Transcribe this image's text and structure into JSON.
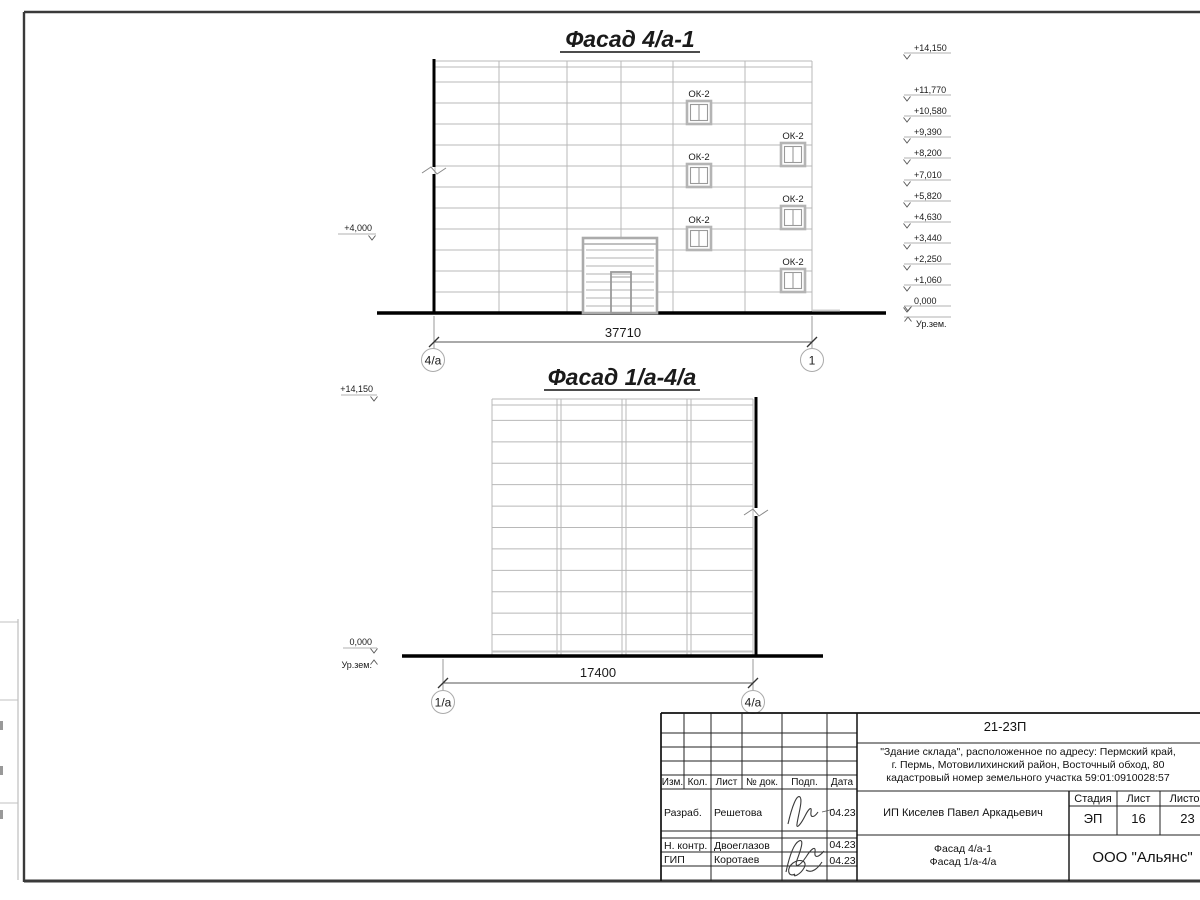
{
  "colors": {
    "paper": "#ffffff",
    "ink": "#1a1a1a",
    "grid": "#b8b8b8"
  },
  "facade_top": {
    "title": "Фасад 4/а-1",
    "window_label": "ОК-2",
    "left_elevation": "+4,000",
    "right_elevations": [
      "+14,150",
      "+11,770",
      "+10,580",
      "+9,390",
      "+8,200",
      "+7,010",
      "+5,820",
      "+4,630",
      "+3,440",
      "+2,250",
      "+1,060",
      "0,000"
    ],
    "ground_label": "Ур.зем.",
    "dimension": "37710",
    "axis_left": "4/а",
    "axis_right": "1"
  },
  "facade_side": {
    "title": "Фасад 1/а-4/а",
    "top_elevation": "+14,150",
    "zero_elevation": "0,000",
    "ground_label": "Ур.зем.",
    "dimension": "17400",
    "axis_left": "1/а",
    "axis_right": "4/а"
  },
  "title_block": {
    "code": "21-23П",
    "description_line1": "\"Здание склада\", расположенное по адресу: Пермский край,",
    "description_line2": "г. Пермь, Мотовилихинский район, Восточный обход, 80",
    "description_line3": "кадастровый номер земельного участка 59:01:0910028:57",
    "col_izm": "Изм.",
    "col_kol": "Кол.",
    "col_list": "Лист",
    "col_doc": "№ док.",
    "col_sign": "Подп.",
    "col_date": "Дата",
    "row1_role": "Разраб.",
    "row1_name": "Решетова",
    "row1_date": "04.23",
    "row2_role": "Н. контр.",
    "row2_name": "Двоеглазов",
    "row2_date": "04.23",
    "row3_role": "ГИП",
    "row3_name": "Коротаев",
    "row3_date": "04.23",
    "client": "ИП Киселев Павел Аркадьевич",
    "stage_label": "Стадия",
    "sheet_label": "Лист",
    "sheets_label": "Листов",
    "stage_value": "ЭП",
    "sheet_value": "16",
    "sheets_value": "23",
    "drawing_title_line1": "Фасад 4/а-1",
    "drawing_title_line2": "Фасад 1/а-4/а",
    "organization": "ООО \"Альянс\""
  }
}
